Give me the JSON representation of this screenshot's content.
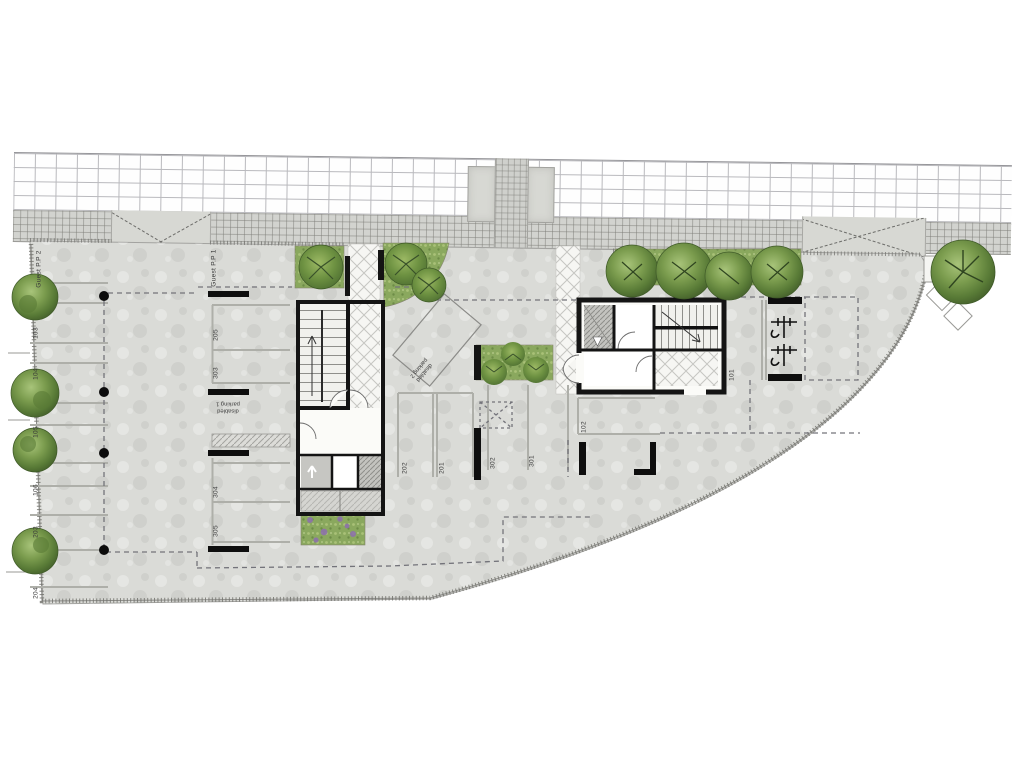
{
  "drawing": {
    "title": "Parking level site plan",
    "colors": {
      "concrete": "#dadbd7",
      "sidewalk": "#d2d3cf",
      "wall_black": "#141414",
      "grass": "#8aa85e",
      "tree_dark": "#46622c",
      "tree_light": "#a8c47a",
      "stripe": "#b0b1ab",
      "dash": "#74747a"
    },
    "labels": {
      "guest_pp2": "Guest P.P 2",
      "guest_pp1": "Guest P.P 1",
      "stall_103": "103",
      "stall_104": "104",
      "stall_105": "105",
      "stall_106": "106",
      "stall_203": "203",
      "stall_204": "204",
      "stall_205": "205",
      "stall_303": "303",
      "stall_304": "304",
      "stall_305": "305",
      "stall_202": "202",
      "stall_201": "201",
      "stall_302": "302",
      "stall_301": "301",
      "stall_102": "102",
      "stall_101": "101",
      "disabled_1_line1": "disabled",
      "disabled_1_line2": "parking 1",
      "disabled_2_line1": "disabled",
      "disabled_2_line2": "parking 2"
    }
  }
}
